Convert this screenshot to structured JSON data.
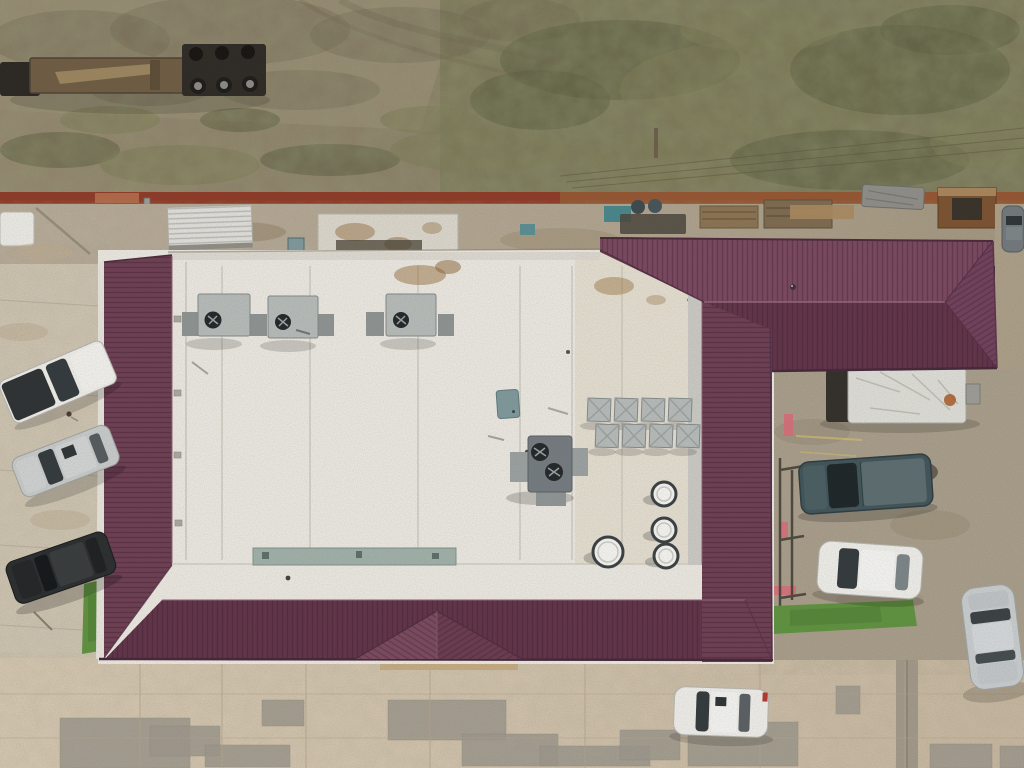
{
  "scene": {
    "type": "aerial-drone-photo",
    "description": "Overhead aerial photo of a commercial building with a burgundy standing-seam hip roof surrounding a white flat membrane roof, an east hip-roof wing, parking areas with vehicles, a rear dirt lot with a lowboy trailer, and a rust-red boundary wall."
  },
  "palette": {
    "dirt_base": "#8a8068",
    "dirt_light": "#958a72",
    "dirt_dark": "#6e634f",
    "scrub_green": "#7b7a56",
    "scrub_dark": "#5f6044",
    "wall_red": "#8e3b28",
    "wall_rust": "#955c35",
    "concrete_strip": "#b3a795",
    "concrete_left": "#cdc3b1",
    "concrete_court": "#a89d8b",
    "concrete_bottom": "#cfc1ab",
    "concrete_patch": "#9c978c",
    "roof_maroon": "#6d3f53",
    "roof_maroon_light": "#7a4860",
    "roof_maroon_dark": "#613449",
    "roof_ridge_hi": "#93637a",
    "roof_eave": "#46273a",
    "roof_white": "#e9e6df",
    "roof_tan": "#d9d0bd",
    "seam": "#c6c2b6",
    "fascia_gray": "#c9c8c2",
    "hvac_gray": "#b5bab8",
    "hvac_dark": "#8d9392",
    "hvac_unit_dark": "#747b80",
    "fan_dark": "#23282b",
    "teal_panel": "#7f989b",
    "teal_strip": "#9fb0a8",
    "grass": "#5f9140",
    "grass_dark": "#4a7a30",
    "trailer_deck": "#6f5c44",
    "trailer_dark": "#2b2823",
    "pallet": "#8a7354",
    "shed_white": "#dfdeda",
    "box_trailer": "#dcdcd6",
    "pink_curb": "#d96a77",
    "yellow_line": "#d8c66a",
    "car_white": "#ecebe7",
    "car_silver": "#c6c9c9",
    "car_black": "#2b2e2f",
    "truck_teal": "#41555a",
    "car_gray": "#71787c",
    "glass_dark": "#333a3d"
  },
  "objects": {
    "top_lot": [
      "bare dirt lot",
      "lowboy flatbed trailer with triple-axle bogie",
      "scrub vegetation",
      "overhead power lines"
    ],
    "mid_strip": [
      "rust-red boundary wall",
      "rear service strip",
      "white ribbed shed",
      "stained flat roof section",
      "pallet piles",
      "debris and bins",
      "gray tarp"
    ],
    "building": [
      "white flat membrane roof",
      "burgundy hip roof perimeter",
      "burgundy east wing hip roof",
      "three rooftop HVAC units",
      "dark twin-fan HVAC unit",
      "cluster of eight square vents",
      "four round vent stacks",
      "entrance porch hip roof"
    ],
    "west_lot": [
      "white pickup truck",
      "silver SUV",
      "black SUV",
      "person",
      "grass strip"
    ],
    "east_court": [
      "white box trailer",
      "dark teal pickup truck",
      "white sedan",
      "pink curb markings",
      "stair railing",
      "grass strip"
    ],
    "south_lot": [
      "concrete lot with gray patch repairs",
      "white hatchback",
      "silver sedan",
      "dark gray car at top right"
    ]
  },
  "scene_data": {
    "roof_seams_x": [
      222,
      310,
      418,
      520,
      572,
      622
    ],
    "vent_cluster": [
      [
        588,
        398
      ],
      [
        615,
        398
      ],
      [
        642,
        398
      ],
      [
        669,
        398
      ],
      [
        596,
        424
      ],
      [
        623,
        424
      ],
      [
        650,
        424
      ],
      [
        677,
        424
      ]
    ],
    "round_vents": [
      [
        608,
        552,
        15
      ],
      [
        664,
        494,
        12
      ],
      [
        664,
        530,
        12
      ],
      [
        666,
        556,
        12
      ]
    ],
    "parapet_vents": [
      [
        174,
        316
      ],
      [
        174,
        390
      ],
      [
        174,
        452
      ],
      [
        175,
        520
      ]
    ],
    "gray_patches": [
      [
        60,
        718,
        130,
        50
      ],
      [
        150,
        726,
        70,
        30
      ],
      [
        205,
        745,
        85,
        22
      ],
      [
        262,
        700,
        42,
        26
      ],
      [
        388,
        700,
        118,
        40
      ],
      [
        462,
        734,
        96,
        32
      ],
      [
        540,
        746,
        110,
        20
      ],
      [
        620,
        730,
        60,
        30
      ],
      [
        688,
        722,
        110,
        44
      ],
      [
        836,
        686,
        24,
        28
      ],
      [
        930,
        744,
        62,
        24
      ],
      [
        1000,
        746,
        24,
        22
      ]
    ],
    "joint_lines_v": [
      140,
      222,
      306,
      430,
      585,
      760,
      905
    ],
    "joint_lines_h": [
      694,
      738
    ],
    "left_joints_y": [
      300,
      390,
      470,
      545,
      625
    ],
    "scrub_blobs": [
      [
        60,
        150,
        60,
        18
      ],
      [
        180,
        165,
        80,
        20
      ],
      [
        330,
        160,
        70,
        16
      ],
      [
        480,
        150,
        90,
        22
      ],
      [
        620,
        60,
        120,
        40
      ],
      [
        760,
        90,
        140,
        50
      ],
      [
        900,
        70,
        110,
        45
      ],
      [
        680,
        160,
        90,
        25
      ],
      [
        850,
        160,
        120,
        30
      ],
      [
        990,
        140,
        60,
        30
      ],
      [
        540,
        100,
        70,
        30
      ],
      [
        430,
        120,
        50,
        14
      ],
      [
        950,
        30,
        70,
        25
      ],
      [
        760,
        30,
        80,
        22
      ],
      [
        240,
        120,
        40,
        12
      ],
      [
        110,
        120,
        50,
        14
      ]
    ],
    "dirt_patches": [
      [
        80,
        40,
        90,
        30
      ],
      [
        230,
        30,
        120,
        35
      ],
      [
        400,
        35,
        90,
        28
      ],
      [
        520,
        20,
        60,
        22
      ],
      [
        300,
        90,
        80,
        20
      ],
      [
        150,
        90,
        60,
        16
      ]
    ],
    "power_lines": [
      [
        560,
        176,
        1024,
        128
      ],
      [
        566,
        182,
        1024,
        138
      ],
      [
        572,
        188,
        1024,
        148
      ]
    ]
  }
}
